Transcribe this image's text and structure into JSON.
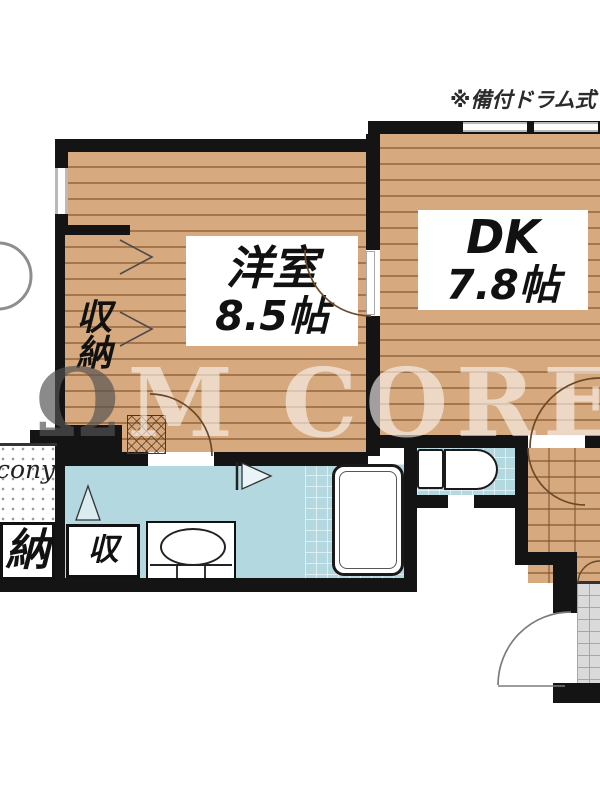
{
  "annotation": {
    "note": "※備付ドラム式"
  },
  "watermark": {
    "prefix": "Ω",
    "brand": "M CORE"
  },
  "rooms": {
    "western": {
      "name": "洋室",
      "size": "8.5帖"
    },
    "dk": {
      "name": "DK",
      "size": "7.8帖"
    },
    "closet": {
      "label": "収納"
    },
    "storage": {
      "label": "納"
    },
    "storage_small": {
      "label": "収"
    },
    "balcony": {
      "label": "cony"
    }
  },
  "colors": {
    "wall": "#141414",
    "wood": "#d6a97e",
    "water": "#b3d8e0",
    "tile": "#dadada",
    "labelbg": "#ffffff",
    "arc": "#6b4a2a"
  }
}
